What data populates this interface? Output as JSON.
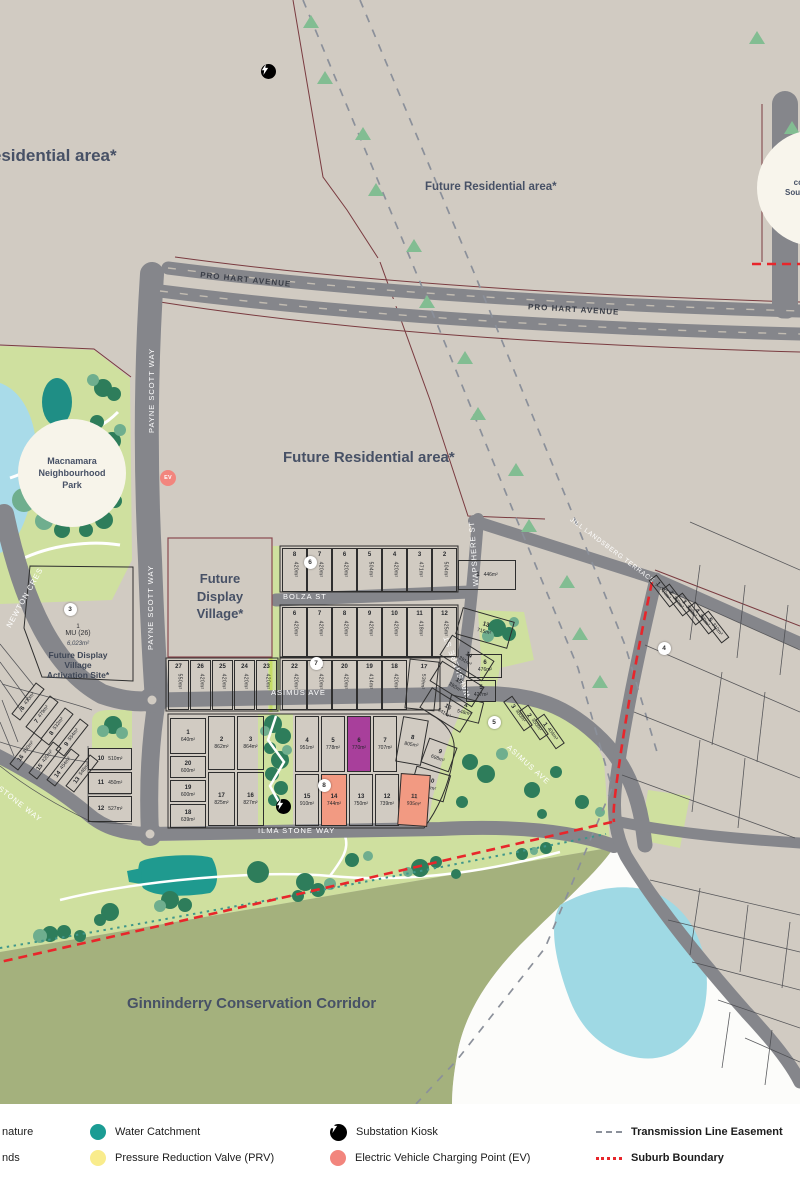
{
  "areas": {
    "future_residential": "Future Residential area*",
    "conservation_corridor": "Ginninderry Conservation Corridor",
    "display_village_lines": [
      "Future",
      "Display",
      "Village*"
    ],
    "activation": {
      "lot_num": "1",
      "zoning": "MU (26)",
      "area": "6,023m²",
      "name_line1": "Future Display Village",
      "name_line2": "Activation Site*"
    },
    "macnamara_lines": [
      "Macnamara",
      "Neighbourhood",
      "Park"
    ],
    "connection_lines": [
      "Future",
      "connection",
      "Southern Cross",
      "Drive"
    ]
  },
  "streets": {
    "pro_hart": "PRO HART AVENUE",
    "payne_scott": "PAYNE SCOTT WAY",
    "newton": "NEWTON CRES",
    "bolza": "BOLZA ST",
    "asimus": "ASIMUS AVE",
    "wapshere": "WAPSHERE ST",
    "ilma": "ILMA STONE WAY",
    "jill": "JILL LANDSBERG TERRACE"
  },
  "legend": {
    "items": [
      {
        "label": "nature",
        "type": "none",
        "x": 2,
        "y": 1132,
        "bold": false
      },
      {
        "label": "nds",
        "type": "none",
        "x": 2,
        "y": 1158,
        "bold": false
      },
      {
        "label": "Water Catchment",
        "type": "circle",
        "color": "#1b9c94",
        "x": 90,
        "y": 1132,
        "bold": false
      },
      {
        "label": "Pressure Reduction Valve (PRV)",
        "type": "circle",
        "color": "#f9ec8c",
        "x": 90,
        "y": 1158,
        "bold": false
      },
      {
        "label": "Substation Kiosk",
        "type": "kiosk",
        "color": "#000000",
        "x": 330,
        "y": 1132,
        "bold": false
      },
      {
        "label": "Electric Vehicle Charging Point (EV)",
        "type": "circle",
        "color": "#f2857d",
        "x": 330,
        "y": 1158,
        "bold": false
      },
      {
        "label": "Transmission Line Easement",
        "type": "dash",
        "color": "#8b909a",
        "x": 596,
        "y": 1132,
        "bold": true
      },
      {
        "label": "Suburb Boundary",
        "type": "dots",
        "color": "#e8262b",
        "x": 596,
        "y": 1158,
        "bold": true
      }
    ]
  },
  "colors": {
    "base": "#d1cbc2",
    "road": "#85868b",
    "park": "#cfe09f",
    "corridor": "#a4b17d",
    "water_catchment": "#1b9c94",
    "pond": "#a9dbe9",
    "lake": "#9fd9e4",
    "purple_lot": "#a83f9b",
    "salmon": "#f29a82",
    "suburb_boundary": "#e8262b",
    "parcel_line": "#7a3b40",
    "label": "#475166",
    "tree": "#82bd92"
  },
  "lots": [
    {
      "n": "8",
      "a": "420m²",
      "x": 282,
      "y": 548,
      "w": 25,
      "h": 44,
      "m": "v"
    },
    {
      "n": "7",
      "a": "420m²",
      "x": 307,
      "y": 548,
      "w": 25,
      "h": 44,
      "m": "v"
    },
    {
      "n": "6",
      "a": "420m²",
      "x": 332,
      "y": 548,
      "w": 25,
      "h": 44,
      "m": "v"
    },
    {
      "n": "5",
      "a": "504m²",
      "x": 357,
      "y": 548,
      "w": 25,
      "h": 44,
      "m": "v"
    },
    {
      "n": "4",
      "a": "420m²",
      "x": 382,
      "y": 548,
      "w": 25,
      "h": 44,
      "m": "v"
    },
    {
      "n": "3",
      "a": "471m²",
      "x": 407,
      "y": 548,
      "w": 25,
      "h": 44,
      "m": "v"
    },
    {
      "n": "2",
      "a": "504m²",
      "x": 432,
      "y": 548,
      "w": 25,
      "h": 44,
      "m": "v"
    },
    {
      "n": "1",
      "a": "446m²",
      "x": 458,
      "y": 560,
      "w": 58,
      "h": 30,
      "m": "h1"
    },
    {
      "n": "6",
      "a": "420m²",
      "x": 282,
      "y": 607,
      "w": 25,
      "h": 50,
      "m": "v"
    },
    {
      "n": "7",
      "a": "420m²",
      "x": 307,
      "y": 607,
      "w": 25,
      "h": 50,
      "m": "v"
    },
    {
      "n": "8",
      "a": "420m²",
      "x": 332,
      "y": 607,
      "w": 25,
      "h": 50,
      "m": "v"
    },
    {
      "n": "9",
      "a": "420m²",
      "x": 357,
      "y": 607,
      "w": 25,
      "h": 50,
      "m": "v"
    },
    {
      "n": "10",
      "a": "420m²",
      "x": 382,
      "y": 607,
      "w": 25,
      "h": 50,
      "m": "v"
    },
    {
      "n": "11",
      "a": "418m²",
      "x": 407,
      "y": 607,
      "w": 25,
      "h": 50,
      "m": "v"
    },
    {
      "n": "12",
      "a": "425m²",
      "x": 432,
      "y": 607,
      "w": 25,
      "h": 50,
      "m": "v"
    },
    {
      "n": "13",
      "a": "715m²",
      "x": 458,
      "y": 614,
      "w": 54,
      "h": 28,
      "m": "h",
      "r": 16
    },
    {
      "n": "22",
      "a": "420m²",
      "x": 282,
      "y": 660,
      "w": 25,
      "h": 50,
      "m": "v"
    },
    {
      "n": "21",
      "a": "420m²",
      "x": 307,
      "y": 660,
      "w": 25,
      "h": 50,
      "m": "v"
    },
    {
      "n": "20",
      "a": "420m²",
      "x": 332,
      "y": 660,
      "w": 25,
      "h": 50,
      "m": "v"
    },
    {
      "n": "19",
      "a": "414m²",
      "x": 357,
      "y": 660,
      "w": 25,
      "h": 50,
      "m": "v"
    },
    {
      "n": "18",
      "a": "420m²",
      "x": 382,
      "y": 660,
      "w": 25,
      "h": 50,
      "m": "v"
    },
    {
      "n": "17",
      "a": "539m²",
      "x": 407,
      "y": 660,
      "w": 30,
      "h": 50,
      "m": "v",
      "r": 6
    },
    {
      "n": "14",
      "a": "391m²",
      "x": 442,
      "y": 646,
      "w": 50,
      "h": 24,
      "m": "h",
      "r": 32
    },
    {
      "n": "15",
      "a": "392m²",
      "x": 432,
      "y": 672,
      "w": 50,
      "h": 24,
      "m": "h",
      "r": 32
    },
    {
      "n": "16",
      "a": "541m²",
      "x": 422,
      "y": 698,
      "w": 48,
      "h": 24,
      "m": "h",
      "r": 32
    },
    {
      "n": "27",
      "a": "550m²",
      "x": 168,
      "y": 660,
      "w": 21,
      "h": 50,
      "m": "v"
    },
    {
      "n": "26",
      "a": "420m²",
      "x": 190,
      "y": 660,
      "w": 21,
      "h": 50,
      "m": "v"
    },
    {
      "n": "25",
      "a": "420m²",
      "x": 212,
      "y": 660,
      "w": 21,
      "h": 50,
      "m": "v"
    },
    {
      "n": "24",
      "a": "420m²",
      "x": 234,
      "y": 660,
      "w": 21,
      "h": 50,
      "m": "v"
    },
    {
      "n": "23",
      "a": "420m²",
      "x": 256,
      "y": 660,
      "w": 21,
      "h": 50,
      "m": "v"
    },
    {
      "n": "6",
      "a": "476m²",
      "x": 468,
      "y": 654,
      "w": 34,
      "h": 24,
      "m": "h"
    },
    {
      "n": "5",
      "a": "427m²",
      "x": 466,
      "y": 680,
      "w": 30,
      "h": 22,
      "m": "h"
    },
    {
      "n": "4",
      "a": "548m²",
      "x": 448,
      "y": 698,
      "w": 34,
      "h": 22,
      "m": "h",
      "r": 14
    },
    {
      "n": "3",
      "a": "380m²",
      "x": 500,
      "y": 708,
      "w": 36,
      "h": 11,
      "m": "i",
      "r": 55
    },
    {
      "n": "2",
      "a": "350m²",
      "x": 516,
      "y": 717,
      "w": 36,
      "h": 11,
      "m": "i",
      "r": 55
    },
    {
      "n": "1",
      "a": "404m²",
      "x": 532,
      "y": 726,
      "w": 36,
      "h": 11,
      "m": "i",
      "r": 55
    },
    {
      "n": "1",
      "a": "640m²",
      "x": 170,
      "y": 718,
      "w": 36,
      "h": 36,
      "m": "h"
    },
    {
      "n": "20",
      "a": "600m²",
      "x": 170,
      "y": 756,
      "w": 36,
      "h": 22,
      "m": "h"
    },
    {
      "n": "19",
      "a": "600m²",
      "x": 170,
      "y": 780,
      "w": 36,
      "h": 22,
      "m": "h"
    },
    {
      "n": "18",
      "a": "639m²",
      "x": 170,
      "y": 804,
      "w": 36,
      "h": 24,
      "m": "h"
    },
    {
      "n": "2",
      "a": "862m²",
      "x": 208,
      "y": 716,
      "w": 27,
      "h": 54,
      "m": "h"
    },
    {
      "n": "3",
      "a": "864m²",
      "x": 237,
      "y": 716,
      "w": 27,
      "h": 54,
      "m": "h"
    },
    {
      "n": "17",
      "a": "825m²",
      "x": 208,
      "y": 772,
      "w": 27,
      "h": 54,
      "m": "h"
    },
    {
      "n": "16",
      "a": "827m²",
      "x": 237,
      "y": 772,
      "w": 27,
      "h": 54,
      "m": "h"
    },
    {
      "n": "4",
      "a": "951m²",
      "x": 295,
      "y": 716,
      "w": 24,
      "h": 56,
      "m": "h"
    },
    {
      "n": "5",
      "a": "778m²",
      "x": 321,
      "y": 716,
      "w": 24,
      "h": 56,
      "m": "h"
    },
    {
      "n": "6",
      "a": "770m²",
      "x": 347,
      "y": 716,
      "w": 24,
      "h": 56,
      "m": "h",
      "f": "#a83f9b"
    },
    {
      "n": "7",
      "a": "707m²",
      "x": 373,
      "y": 716,
      "w": 24,
      "h": 56,
      "m": "h"
    },
    {
      "n": "8",
      "a": "805m²",
      "x": 399,
      "y": 718,
      "w": 26,
      "h": 46,
      "m": "h",
      "r": 10
    },
    {
      "n": "9",
      "a": "698m²",
      "x": 424,
      "y": 742,
      "w": 30,
      "h": 26,
      "m": "h",
      "r": 20
    },
    {
      "n": "10",
      "a": "850m²",
      "x": 412,
      "y": 770,
      "w": 36,
      "h": 28,
      "m": "h",
      "r": 16
    },
    {
      "n": "15",
      "a": "910m²",
      "x": 295,
      "y": 774,
      "w": 24,
      "h": 52,
      "m": "h"
    },
    {
      "n": "14",
      "a": "744m²",
      "x": 321,
      "y": 774,
      "w": 26,
      "h": 52,
      "m": "h",
      "f": "#f29a82"
    },
    {
      "n": "13",
      "a": "750m²",
      "x": 349,
      "y": 774,
      "w": 24,
      "h": 52,
      "m": "h"
    },
    {
      "n": "12",
      "a": "739m²",
      "x": 375,
      "y": 774,
      "w": 24,
      "h": 52,
      "m": "h"
    },
    {
      "n": "11",
      "a": "935m²",
      "x": 399,
      "y": 774,
      "w": 30,
      "h": 52,
      "m": "h",
      "r": 4,
      "f": "#f29a82"
    },
    {
      "n": "6",
      "a": "430m²",
      "x": 8,
      "y": 696,
      "w": 40,
      "h": 11,
      "m": "i",
      "r": -52
    },
    {
      "n": "7",
      "a": "479m²",
      "x": 22,
      "y": 709,
      "w": 40,
      "h": 11,
      "m": "i",
      "r": -52
    },
    {
      "n": "8",
      "a": "532m²",
      "x": 37,
      "y": 721,
      "w": 40,
      "h": 11,
      "m": "i",
      "r": -52
    },
    {
      "n": "9",
      "a": "554m²",
      "x": 52,
      "y": 732,
      "w": 40,
      "h": 11,
      "m": "i",
      "r": -52
    },
    {
      "n": "16",
      "a": "350m²",
      "x": 6,
      "y": 746,
      "w": 40,
      "h": 11,
      "m": "i",
      "r": -52
    },
    {
      "n": "15",
      "a": "420m²",
      "x": 25,
      "y": 755,
      "w": 40,
      "h": 11,
      "m": "i",
      "r": -52
    },
    {
      "n": "14",
      "a": "454m²",
      "x": 43,
      "y": 762,
      "w": 40,
      "h": 11,
      "m": "i",
      "r": -52
    },
    {
      "n": "13",
      "a": "546m²",
      "x": 62,
      "y": 768,
      "w": 40,
      "h": 11,
      "m": "i",
      "r": -52
    },
    {
      "n": "10",
      "a": "510m²",
      "x": 88,
      "y": 748,
      "w": 44,
      "h": 22,
      "m": "h1"
    },
    {
      "n": "11",
      "a": "450m²",
      "x": 88,
      "y": 772,
      "w": 44,
      "h": 22,
      "m": "h1"
    },
    {
      "n": "12",
      "a": "527m²",
      "x": 88,
      "y": 796,
      "w": 44,
      "h": 26,
      "m": "h1"
    },
    {
      "n": "1",
      "a": "310m²",
      "x": 646,
      "y": 586,
      "w": 34,
      "h": 10,
      "m": "i",
      "r": 52
    },
    {
      "n": "2",
      "a": "260m²",
      "x": 659,
      "y": 595,
      "w": 34,
      "h": 10,
      "m": "i",
      "r": 52
    },
    {
      "n": "3",
      "a": "328m²",
      "x": 672,
      "y": 604,
      "w": 34,
      "h": 10,
      "m": "i",
      "r": 52
    },
    {
      "n": "4",
      "a": "280m²",
      "x": 685,
      "y": 613,
      "w": 34,
      "h": 10,
      "m": "i",
      "r": 52
    },
    {
      "n": "5",
      "a": "310m²",
      "x": 698,
      "y": 622,
      "w": 34,
      "h": 10,
      "m": "i",
      "r": 52
    }
  ],
  "markers": [
    {
      "k": "kiosk",
      "x": 268,
      "y": 71
    },
    {
      "k": "kiosk",
      "x": 283,
      "y": 806
    },
    {
      "k": "ev",
      "t": "EV",
      "x": 168,
      "y": 478
    },
    {
      "k": "num",
      "t": "3",
      "x": 70,
      "y": 609
    },
    {
      "k": "num",
      "t": "4",
      "x": 664,
      "y": 648
    },
    {
      "k": "num",
      "t": "5",
      "x": 494,
      "y": 722
    },
    {
      "k": "num",
      "t": "6",
      "x": 310,
      "y": 562
    },
    {
      "k": "num",
      "t": "7",
      "x": 316,
      "y": 663
    },
    {
      "k": "num",
      "t": "8",
      "x": 324,
      "y": 785
    }
  ],
  "easement_trees": [
    [
      311,
      22
    ],
    [
      325,
      78
    ],
    [
      363,
      134
    ],
    [
      376,
      190
    ],
    [
      414,
      246
    ],
    [
      427,
      302
    ],
    [
      465,
      358
    ],
    [
      478,
      414
    ],
    [
      516,
      470
    ],
    [
      529,
      526
    ],
    [
      567,
      582
    ],
    [
      580,
      634
    ],
    [
      600,
      682
    ],
    [
      757,
      38
    ],
    [
      792,
      128
    ]
  ]
}
